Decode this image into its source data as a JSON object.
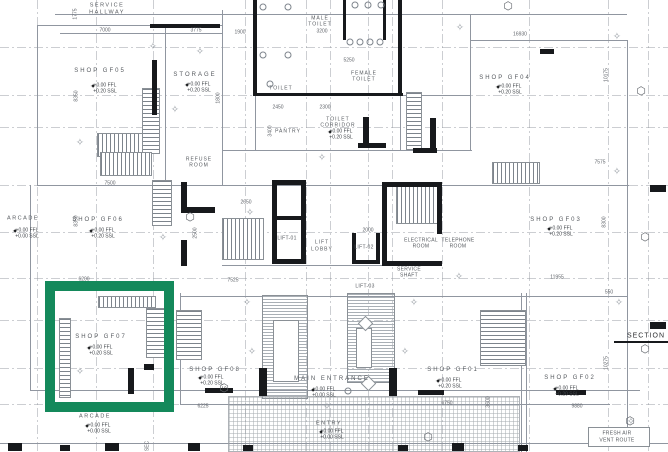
{
  "drawing": {
    "type": "architectural-floor-plan",
    "highlight": {
      "x": 45,
      "y": 281,
      "w": 129,
      "h": 131,
      "border": 10,
      "color": "#14895B"
    }
  },
  "labels": [
    {
      "n": "label-service-hallway",
      "t": "SERVICE",
      "x": 107,
      "y": 6,
      "c": "rs"
    },
    {
      "n": "label-service-hallway",
      "t": "HALLWAY",
      "x": 107,
      "y": 13,
      "c": "rs"
    },
    {
      "n": "dim-7000",
      "t": "7000",
      "x": 105,
      "y": 31,
      "c": "dm"
    },
    {
      "n": "dim-3775",
      "t": "3775",
      "x": 196,
      "y": 31,
      "c": "dm"
    },
    {
      "n": "dim-1775",
      "t": "1775",
      "x": 76,
      "y": 14,
      "c": "dm",
      "r": 1
    },
    {
      "n": "dim-1900",
      "t": "1900",
      "x": 240,
      "y": 33,
      "c": "dm"
    },
    {
      "n": "dim-16930",
      "t": "16930",
      "x": 520,
      "y": 35,
      "c": "dm"
    },
    {
      "n": "room-male-toilet",
      "t": "MALE",
      "x": 320,
      "y": 19,
      "c": "rx"
    },
    {
      "n": "room-male-toilet",
      "t": "TOILET",
      "x": 320,
      "y": 25,
      "c": "rx"
    },
    {
      "n": "dim-3200",
      "t": "3200",
      "x": 322,
      "y": 32,
      "c": "dm"
    },
    {
      "n": "dim-5250",
      "t": "5250",
      "x": 349,
      "y": 61,
      "c": "dm"
    },
    {
      "n": "room-female-toilet",
      "t": "FEMALE",
      "x": 364,
      "y": 74,
      "c": "rx"
    },
    {
      "n": "room-female-toilet",
      "t": "TOILET",
      "x": 364,
      "y": 80,
      "c": "rx"
    },
    {
      "n": "room-toilet",
      "t": "TOILET",
      "x": 281,
      "y": 89,
      "c": "rx"
    },
    {
      "n": "dim-2450",
      "t": "2450",
      "x": 278,
      "y": 108,
      "c": "dm"
    },
    {
      "n": "dim-2300",
      "t": "2300",
      "x": 325,
      "y": 108,
      "c": "dm"
    },
    {
      "n": "dim-3400",
      "t": "3400",
      "x": 271,
      "y": 131,
      "c": "dm",
      "r": 1
    },
    {
      "n": "room-pantry",
      "t": "PANTRY",
      "x": 288,
      "y": 132,
      "c": "rx"
    },
    {
      "n": "room-toilet-corridor",
      "t": "TOILET",
      "x": 338,
      "y": 120,
      "c": "rx"
    },
    {
      "n": "room-toilet-corridor",
      "t": "CORRIDOR",
      "x": 338,
      "y": 126,
      "c": "rx"
    },
    {
      "n": "level-ffl",
      "t": "+0.00 FFL",
      "x": 341,
      "y": 132,
      "c": "lv"
    },
    {
      "n": "level-ssl",
      "t": "+0.20 SSL",
      "x": 341,
      "y": 138,
      "c": "lv"
    },
    {
      "n": "spot-level-marker",
      "t": "✦",
      "x": 330,
      "y": 133,
      "c": "sp"
    },
    {
      "n": "room-storage",
      "t": "STORAGE",
      "x": 195,
      "y": 75,
      "c": "rm"
    },
    {
      "n": "level-ffl",
      "t": "+0.00 FFL",
      "x": 199,
      "y": 85,
      "c": "lv"
    },
    {
      "n": "level-ssl",
      "t": "+0.20 SSL",
      "x": 199,
      "y": 91,
      "c": "lv"
    },
    {
      "n": "spot-level-marker",
      "t": "✦",
      "x": 187,
      "y": 86,
      "c": "sp"
    },
    {
      "n": "dim-1800",
      "t": "1800",
      "x": 219,
      "y": 98,
      "c": "dm",
      "r": 1
    },
    {
      "n": "room-refuse",
      "t": "REFUSE",
      "x": 199,
      "y": 160,
      "c": "rx"
    },
    {
      "n": "room-refuse",
      "t": "ROOM",
      "x": 199,
      "y": 166,
      "c": "rx"
    },
    {
      "n": "room-shop-gf05",
      "t": "SHOP GF05",
      "x": 100,
      "y": 71,
      "c": "rm"
    },
    {
      "n": "level-ffl",
      "t": "+0.00 FFL",
      "x": 105,
      "y": 86,
      "c": "lv"
    },
    {
      "n": "level-ssl",
      "t": "+0.20 SSL",
      "x": 105,
      "y": 92,
      "c": "lv"
    },
    {
      "n": "spot-level-marker",
      "t": "✦",
      "x": 93,
      "y": 87,
      "c": "sp"
    },
    {
      "n": "dim-8350",
      "t": "8350",
      "x": 77,
      "y": 96,
      "c": "dm",
      "r": 1
    },
    {
      "n": "room-shop-gf04",
      "t": "SHOP GF04",
      "x": 505,
      "y": 78,
      "c": "rm"
    },
    {
      "n": "level-ffl",
      "t": "+0.00 FFL",
      "x": 510,
      "y": 87,
      "c": "lv"
    },
    {
      "n": "level-ssl",
      "t": "+0.20 SSL",
      "x": 510,
      "y": 93,
      "c": "lv"
    },
    {
      "n": "spot-level-marker",
      "t": "✦",
      "x": 498,
      "y": 88,
      "c": "sp"
    },
    {
      "n": "dim-10175",
      "t": "10175",
      "x": 607,
      "y": 75,
      "c": "dm",
      "r": 1
    },
    {
      "n": "dim-7575",
      "t": "7575",
      "x": 600,
      "y": 163,
      "c": "dm"
    },
    {
      "n": "room-arcade-left",
      "t": "ARCADE",
      "x": 23,
      "y": 219,
      "c": "rs"
    },
    {
      "n": "level-ffl",
      "t": "+0.00 FFL",
      "x": 27,
      "y": 231,
      "c": "lv"
    },
    {
      "n": "level-ssl",
      "t": "+0.00 SSL",
      "x": 27,
      "y": 237,
      "c": "lv"
    },
    {
      "n": "spot-level-marker",
      "t": "✦",
      "x": 15,
      "y": 232,
      "c": "sp"
    },
    {
      "n": "room-shop-gf06",
      "t": "SHOP GF06",
      "x": 98,
      "y": 220,
      "c": "rm"
    },
    {
      "n": "level-ffl",
      "t": "+0.00 FFL",
      "x": 103,
      "y": 231,
      "c": "lv"
    },
    {
      "n": "level-ssl",
      "t": "+0.20 SSL",
      "x": 103,
      "y": 237,
      "c": "lv"
    },
    {
      "n": "spot-level-marker",
      "t": "✦",
      "x": 91,
      "y": 232,
      "c": "sp"
    },
    {
      "n": "dim-8350b",
      "t": "8350",
      "x": 77,
      "y": 221,
      "c": "dm",
      "r": 1
    },
    {
      "n": "dim-7500",
      "t": "7500",
      "x": 110,
      "y": 184,
      "c": "dm"
    },
    {
      "n": "dim-2500",
      "t": "2500",
      "x": 196,
      "y": 233,
      "c": "dm",
      "r": 1
    },
    {
      "n": "dim-6200",
      "t": "6200",
      "x": 84,
      "y": 280,
      "c": "dm"
    },
    {
      "n": "dim-2650",
      "t": "2650",
      "x": 246,
      "y": 203,
      "c": "dm"
    },
    {
      "n": "dim-7525",
      "t": "7525",
      "x": 233,
      "y": 281,
      "c": "dm"
    },
    {
      "n": "room-lift-lobby",
      "t": "LIFT",
      "x": 322,
      "y": 243,
      "c": "rx"
    },
    {
      "n": "room-lift-lobby",
      "t": "LOBBY",
      "x": 322,
      "y": 250,
      "c": "rx"
    },
    {
      "n": "room-lift-01",
      "t": "LIFT-01",
      "x": 287,
      "y": 239,
      "c": "tn"
    },
    {
      "n": "room-lift-02",
      "t": "LIFT-02",
      "x": 364,
      "y": 248,
      "c": "tn"
    },
    {
      "n": "room-lift-03",
      "t": "LIFT-03",
      "x": 365,
      "y": 287,
      "c": "tn"
    },
    {
      "n": "dim-2000",
      "t": "2000",
      "x": 368,
      "y": 231,
      "c": "dm"
    },
    {
      "n": "room-electrical",
      "t": "ELECTRICAL",
      "x": 421,
      "y": 241,
      "c": "tn"
    },
    {
      "n": "room-electrical",
      "t": "ROOM",
      "x": 421,
      "y": 247,
      "c": "tn"
    },
    {
      "n": "room-telephone",
      "t": "TELEPHONE",
      "x": 458,
      "y": 241,
      "c": "tn"
    },
    {
      "n": "room-telephone",
      "t": "ROOM",
      "x": 458,
      "y": 247,
      "c": "tn"
    },
    {
      "n": "room-service-shaft",
      "t": "SERVICE",
      "x": 409,
      "y": 270,
      "c": "tn"
    },
    {
      "n": "room-service-shaft",
      "t": "SHAFT",
      "x": 409,
      "y": 276,
      "c": "tn"
    },
    {
      "n": "room-shop-gf03",
      "t": "SHOP GF03",
      "x": 556,
      "y": 220,
      "c": "rm"
    },
    {
      "n": "level-ffl",
      "t": "+0.00 FFL",
      "x": 561,
      "y": 229,
      "c": "lv"
    },
    {
      "n": "level-ssl",
      "t": "+0.20 SSL",
      "x": 561,
      "y": 235,
      "c": "lv"
    },
    {
      "n": "spot-level-marker",
      "t": "✦",
      "x": 549,
      "y": 230,
      "c": "sp"
    },
    {
      "n": "dim-8300",
      "t": "8300",
      "x": 605,
      "y": 222,
      "c": "dm",
      "r": 1
    },
    {
      "n": "dim-11955",
      "t": "11955",
      "x": 557,
      "y": 278,
      "c": "dm"
    },
    {
      "n": "room-shop-gf07",
      "t": "SHOP GF07",
      "x": 101,
      "y": 337,
      "c": "rm"
    },
    {
      "n": "level-ffl",
      "t": "+0.00 FFL",
      "x": 101,
      "y": 348,
      "c": "lv"
    },
    {
      "n": "level-ssl",
      "t": "+0.20 SSL",
      "x": 101,
      "y": 354,
      "c": "lv"
    },
    {
      "n": "spot-level-marker",
      "t": "✦",
      "x": 89,
      "y": 349,
      "c": "sp"
    },
    {
      "n": "room-arcade-bottom",
      "t": "ARCADE",
      "x": 95,
      "y": 417,
      "c": "rs"
    },
    {
      "n": "level-ffl",
      "t": "+0.00 FFL",
      "x": 99,
      "y": 426,
      "c": "lv"
    },
    {
      "n": "level-ssl",
      "t": "+0.00 SSL",
      "x": 99,
      "y": 432,
      "c": "lv"
    },
    {
      "n": "spot-level-marker",
      "t": "✦",
      "x": 87,
      "y": 427,
      "c": "sp"
    },
    {
      "n": "dim-6225",
      "t": "6225",
      "x": 203,
      "y": 407,
      "c": "dm"
    },
    {
      "n": "room-shop-gf08",
      "t": "SHOP GF08",
      "x": 215,
      "y": 370,
      "c": "rm"
    },
    {
      "n": "level-ffl",
      "t": "+0.00 FFL",
      "x": 212,
      "y": 378,
      "c": "lv"
    },
    {
      "n": "level-ssl",
      "t": "+0.20 SSL",
      "x": 212,
      "y": 384,
      "c": "lv"
    },
    {
      "n": "spot-level-marker",
      "t": "✦",
      "x": 200,
      "y": 379,
      "c": "sp"
    },
    {
      "n": "label-main-entrance",
      "t": "MAIN ENTRANCE",
      "x": 332,
      "y": 379,
      "c": "rm"
    },
    {
      "n": "level-ffl",
      "t": "+0.00 FFL",
      "x": 324,
      "y": 390,
      "c": "lv"
    },
    {
      "n": "level-ssl",
      "t": "+0.00 SSL",
      "x": 324,
      "y": 396,
      "c": "lv"
    },
    {
      "n": "spot-level-marker",
      "t": "✦",
      "x": 313,
      "y": 391,
      "c": "sp"
    },
    {
      "n": "label-entry",
      "t": "ENTRY",
      "x": 329,
      "y": 424,
      "c": "rs"
    },
    {
      "n": "level-ffl",
      "t": "+0.00 FFL",
      "x": 332,
      "y": 432,
      "c": "lv"
    },
    {
      "n": "level-ssl",
      "t": "+0.00 SSL",
      "x": 332,
      "y": 438,
      "c": "lv"
    },
    {
      "n": "spot-level-marker",
      "t": "✦",
      "x": 321,
      "y": 433,
      "c": "sp"
    },
    {
      "n": "room-shop-gf01",
      "t": "SHOP GF01",
      "x": 453,
      "y": 370,
      "c": "rm"
    },
    {
      "n": "level-ffl",
      "t": "+0.00 FFL",
      "x": 450,
      "y": 381,
      "c": "lv"
    },
    {
      "n": "level-ssl",
      "t": "+0.20 SSL",
      "x": 450,
      "y": 387,
      "c": "lv"
    },
    {
      "n": "spot-level-marker",
      "t": "✦",
      "x": 438,
      "y": 382,
      "c": "sp"
    },
    {
      "n": "dim-6750",
      "t": "6750",
      "x": 447,
      "y": 404,
      "c": "dm"
    },
    {
      "n": "dim-3600",
      "t": "3600",
      "x": 489,
      "y": 402,
      "c": "dm",
      "r": 1
    },
    {
      "n": "room-shop-gf02",
      "t": "SHOP GF02",
      "x": 570,
      "y": 378,
      "c": "rm"
    },
    {
      "n": "level-ffl",
      "t": "+0.00 FFL",
      "x": 567,
      "y": 389,
      "c": "lv"
    },
    {
      "n": "level-ssl",
      "t": "+0.20 SSL",
      "x": 567,
      "y": 395,
      "c": "lv"
    },
    {
      "n": "spot-level-marker",
      "t": "✦",
      "x": 555,
      "y": 390,
      "c": "sp"
    },
    {
      "n": "dim-9880",
      "t": "9880",
      "x": 577,
      "y": 407,
      "c": "dm"
    },
    {
      "n": "dim-10275",
      "t": "10275",
      "x": 607,
      "y": 363,
      "c": "dm",
      "r": 1
    },
    {
      "n": "dim-550",
      "t": "550",
      "x": 609,
      "y": 293,
      "c": "dm"
    },
    {
      "n": "label-section-right",
      "t": "SECTION",
      "x": 646,
      "y": 336,
      "c": "sec"
    },
    {
      "n": "label-section-bottom",
      "t": "SEC",
      "x": 148,
      "y": 446,
      "c": "dm",
      "r": 1
    },
    {
      "n": "label-fresh-air",
      "t": "FRESH AIR",
      "x": 617,
      "y": 434,
      "c": "tn"
    },
    {
      "n": "label-fresh-air",
      "t": "VENT ROUTE",
      "x": 617,
      "y": 441,
      "c": "tn"
    }
  ],
  "grid": {
    "v": [
      37,
      96,
      153,
      245,
      306,
      330,
      368,
      392,
      442,
      529,
      608,
      648
    ],
    "h": [
      47,
      95,
      127,
      185,
      232,
      278,
      320,
      368,
      404,
      443
    ]
  },
  "lines": {
    "h": [
      [
        55,
        14,
        572
      ],
      [
        37,
        25,
        186
      ],
      [
        255,
        95,
        215
      ],
      [
        222,
        150,
        250
      ],
      [
        37,
        185,
        592
      ],
      [
        222,
        265,
        220
      ],
      [
        180,
        296,
        447
      ],
      [
        30,
        390,
        610
      ],
      [
        180,
        404,
        430
      ],
      [
        0,
        443,
        668
      ],
      [
        60,
        33,
        162
      ],
      [
        470,
        40,
        158
      ]
    ],
    "v": [
      [
        37,
        25,
        160
      ],
      [
        165,
        25,
        160
      ],
      [
        222,
        10,
        175
      ],
      [
        255,
        0,
        150
      ],
      [
        400,
        0,
        150
      ],
      [
        470,
        14,
        136
      ],
      [
        627,
        40,
        403
      ],
      [
        30,
        185,
        205
      ],
      [
        180,
        293,
        112
      ],
      [
        521,
        293,
        160
      ],
      [
        526,
        293,
        160
      ]
    ]
  },
  "walls": [
    [
      150,
      24,
      70,
      4
    ],
    [
      152,
      60,
      5,
      55
    ],
    [
      253,
      0,
      4,
      95
    ],
    [
      343,
      0,
      3,
      40
    ],
    [
      383,
      0,
      3,
      40
    ],
    [
      398,
      0,
      4,
      95
    ],
    [
      253,
      93,
      150,
      3
    ],
    [
      363,
      117,
      6,
      30
    ],
    [
      358,
      143,
      28,
      5
    ],
    [
      430,
      118,
      6,
      32
    ],
    [
      413,
      148,
      24,
      5
    ],
    [
      181,
      182,
      6,
      30
    ],
    [
      181,
      207,
      34,
      6
    ],
    [
      181,
      240,
      6,
      26
    ],
    [
      272,
      180,
      34,
      5
    ],
    [
      272,
      180,
      5,
      84
    ],
    [
      301,
      180,
      5,
      84
    ],
    [
      272,
      259,
      34,
      5
    ],
    [
      272,
      216,
      34,
      4
    ],
    [
      382,
      182,
      60,
      5
    ],
    [
      382,
      182,
      5,
      84
    ],
    [
      382,
      261,
      60,
      5
    ],
    [
      437,
      182,
      5,
      52
    ],
    [
      352,
      233,
      4,
      30
    ],
    [
      376,
      233,
      4,
      30
    ],
    [
      352,
      260,
      28,
      4
    ],
    [
      540,
      49,
      14,
      5
    ],
    [
      650,
      185,
      16,
      7
    ],
    [
      650,
      322,
      16,
      7
    ],
    [
      128,
      368,
      6,
      26
    ],
    [
      144,
      364,
      10,
      6
    ],
    [
      259,
      368,
      8,
      28
    ],
    [
      389,
      368,
      8,
      28
    ],
    [
      205,
      388,
      28,
      5
    ],
    [
      418,
      390,
      26,
      5
    ],
    [
      556,
      390,
      30,
      5
    ],
    [
      8,
      443,
      14,
      8
    ],
    [
      60,
      445,
      10,
      6
    ],
    [
      105,
      443,
      14,
      8
    ],
    [
      188,
      443,
      12,
      8
    ],
    [
      243,
      445,
      10,
      6
    ],
    [
      398,
      445,
      10,
      6
    ],
    [
      452,
      443,
      12,
      8
    ],
    [
      518,
      445,
      10,
      6
    ],
    [
      614,
      341,
      54,
      2
    ]
  ],
  "stairs": [
    [
      97,
      133,
      46,
      24,
      "v"
    ],
    [
      142,
      88,
      18,
      66,
      "h"
    ],
    [
      100,
      152,
      52,
      24,
      "v"
    ],
    [
      152,
      180,
      20,
      46,
      "h"
    ],
    [
      222,
      218,
      42,
      42,
      "v"
    ],
    [
      396,
      186,
      44,
      38,
      "v"
    ],
    [
      492,
      162,
      48,
      22,
      "v"
    ],
    [
      480,
      310,
      46,
      56,
      "h"
    ],
    [
      98,
      296,
      58,
      12,
      "v"
    ],
    [
      146,
      308,
      26,
      50,
      "h"
    ],
    [
      176,
      310,
      26,
      50,
      "h"
    ],
    [
      406,
      92,
      16,
      58,
      "h"
    ],
    [
      59,
      318,
      12,
      80,
      "h"
    ]
  ],
  "hatches": [
    {
      "x": 262,
      "y": 295,
      "w": 46,
      "h": 104,
      "t": "h"
    },
    {
      "x": 347,
      "y": 293,
      "w": 48,
      "h": 90,
      "t": "h"
    },
    {
      "x": 228,
      "y": 396,
      "w": 292,
      "h": 56,
      "t": "g"
    }
  ],
  "whiteboxes": [
    [
      273,
      320,
      26,
      62
    ],
    [
      356,
      328,
      16,
      40
    ],
    [
      588,
      427,
      62,
      20
    ]
  ],
  "rotboxes": [
    [
      360,
      318,
      11
    ],
    [
      363,
      378,
      11
    ]
  ],
  "gstars": [
    [
      153,
      47
    ],
    [
      200,
      52
    ],
    [
      175,
      110
    ],
    [
      617,
      37
    ],
    [
      460,
      28
    ],
    [
      163,
      238
    ],
    [
      322,
      158
    ],
    [
      250,
      213
    ],
    [
      617,
      172
    ],
    [
      247,
      303
    ],
    [
      414,
      303
    ],
    [
      252,
      352
    ],
    [
      405,
      352
    ],
    [
      619,
      303
    ],
    [
      631,
      422
    ],
    [
      459,
      277
    ],
    [
      80,
      143
    ],
    [
      327,
      407
    ],
    [
      80,
      372
    ]
  ],
  "hexes": [
    [
      508,
      6,
      ""
    ],
    [
      641,
      91,
      ""
    ],
    [
      645,
      237,
      ""
    ],
    [
      645,
      349,
      ""
    ],
    [
      630,
      421,
      ""
    ],
    [
      224,
      388,
      "10"
    ],
    [
      190,
      217,
      ""
    ],
    [
      428,
      437,
      ""
    ]
  ],
  "circles": [
    [
      355,
      5
    ],
    [
      368,
      5
    ],
    [
      381,
      5
    ],
    [
      350,
      42
    ],
    [
      360,
      42
    ],
    [
      370,
      42
    ],
    [
      380,
      42
    ],
    [
      263,
      7
    ],
    [
      288,
      7
    ],
    [
      263,
      55
    ],
    [
      288,
      55
    ],
    [
      270,
      84
    ],
    [
      348,
      391
    ]
  ]
}
